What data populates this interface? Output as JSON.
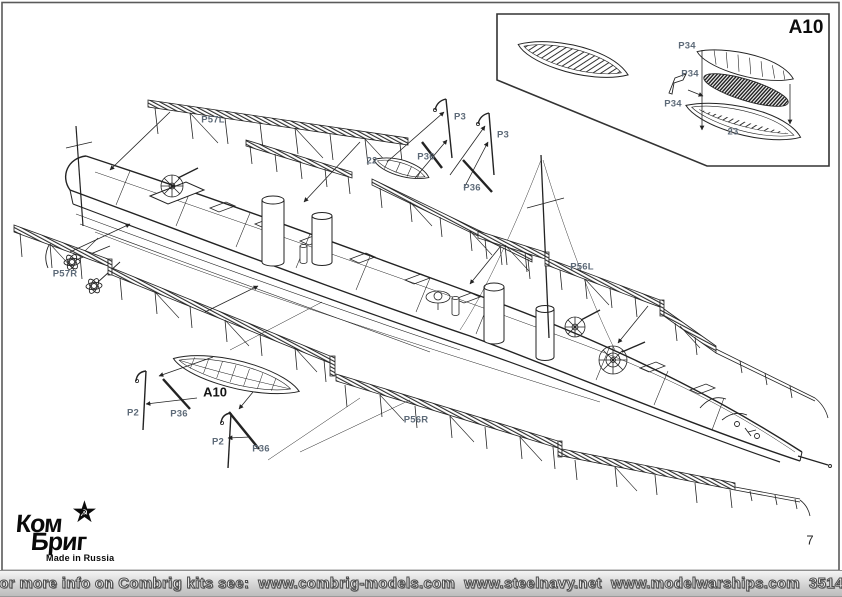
{
  "page_number": "7",
  "inset": {
    "title": "A10",
    "parts": [
      {
        "label": "P34",
        "x": 687,
        "y": 46
      },
      {
        "label": "P34",
        "x": 690,
        "y": 74
      },
      {
        "label": "P34",
        "x": 673,
        "y": 104
      },
      {
        "label": "23",
        "x": 733,
        "y": 132
      }
    ]
  },
  "diagram": {
    "labels": [
      {
        "text": "P57L",
        "x": 213,
        "y": 120
      },
      {
        "text": "P3",
        "x": 460,
        "y": 117
      },
      {
        "text": "P3",
        "x": 503,
        "y": 135
      },
      {
        "text": "P36",
        "x": 426,
        "y": 157
      },
      {
        "text": "22",
        "x": 372,
        "y": 161
      },
      {
        "text": "P36",
        "x": 472,
        "y": 188
      },
      {
        "text": "P57R",
        "x": 65,
        "y": 274
      },
      {
        "text": "P56L",
        "x": 582,
        "y": 267
      },
      {
        "text": "A10",
        "x": 215,
        "y": 392,
        "bold": true
      },
      {
        "text": "P2",
        "x": 133,
        "y": 413
      },
      {
        "text": "P36",
        "x": 179,
        "y": 414
      },
      {
        "text": "P2",
        "x": 218,
        "y": 442
      },
      {
        "text": "P36",
        "x": 261,
        "y": 449
      },
      {
        "text": "P56R",
        "x": 416,
        "y": 420
      }
    ]
  },
  "logo": {
    "line1": "Ком",
    "line2": "Бриг",
    "tagline": "Made in Russia",
    "star_icon": "★",
    "hammer_sickle_icon": "☭"
  },
  "footer": {
    "prefix": "For more info on Combrig kits see:",
    "links": [
      "www.combrig-models.com",
      "www.steelnavy.net",
      "www.modelwarships.com"
    ],
    "kit_number": "35142"
  },
  "colors": {
    "line": "#232323",
    "label": "#5d6a78",
    "footer_bar": "#d4d4d4"
  }
}
